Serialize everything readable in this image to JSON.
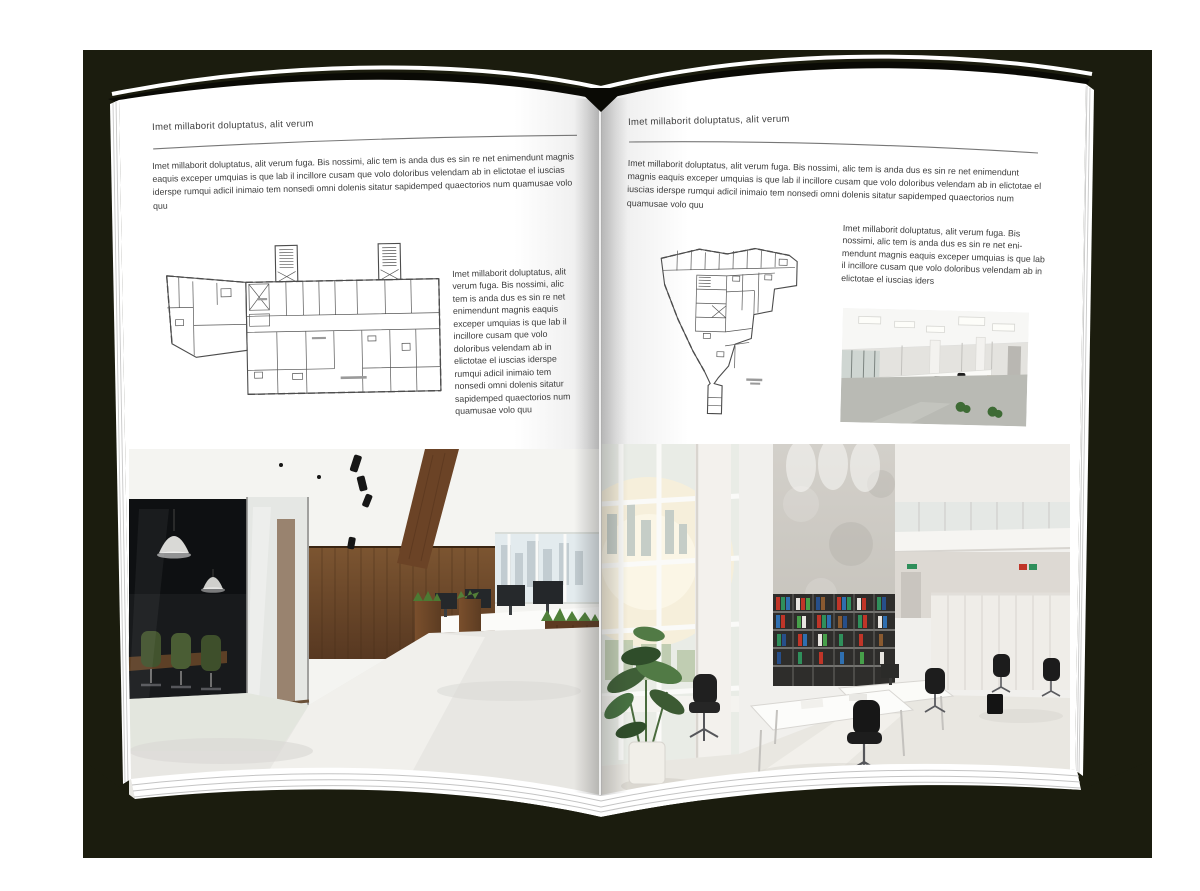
{
  "colors": {
    "backdrop": "#1b1c0e",
    "cover_edge": "#0a0a05",
    "paper": "#ffffff",
    "body_text": "#3c3c3c",
    "rule": "#777777"
  },
  "spread": {
    "left_page": {
      "kicker": "Imet millaborit doluptatus, alit verum",
      "intro": "Imet millaborit doluptatus, alit verum fuga. Bis nossimi, alic tem is anda dus es sin re net enimendunt magnis eaquis exceper umquias is que lab il incillore cusam que volo doloribus velendam ab in elictotae el iuscias iderspe rumqui adicil inimaio tem nonsedi omni dolenis sitatur sapidemped quaectorios num quamusae volo quu",
      "caption": "Imet millaborit doluptatus, alit verum fuga. Bis nossimi, alic tem is anda dus es sin re net enimendunt magnis eaquis exceper umquias is que lab il incillore cusam que volo doloribus velendam ab in elictotae el iuscias iderspe rumqui adicil inimaio tem nonsedi omni dolenis sitatur sapidemped quaectorios num quamusae volo quu"
    },
    "right_page": {
      "kicker": "Imet millaborit doluptatus, alit verum",
      "intro": "Imet millaborit doluptatus, alit verum fuga. Bis nossimi, alic tem is anda dus es sin re net enimendunt magnis eaquis exceper umquias is que lab il incillore cusam que volo doloribus velendam ab in elictotae el iuscias iderspe rumqui adicil inimaio tem nonsedi omni dolenis sitatur sapidemped quaectorios num quamusae volo quu",
      "caption": "Imet millaborit doluptatus, alit verum fuga. Bis nossimi, alic tem is anda dus es sin re net eni-mendunt magnis eaquis exceper umquias is que lab il incillore cusam que volo doloribus velendam ab in elictotae el iuscias iders"
    }
  }
}
